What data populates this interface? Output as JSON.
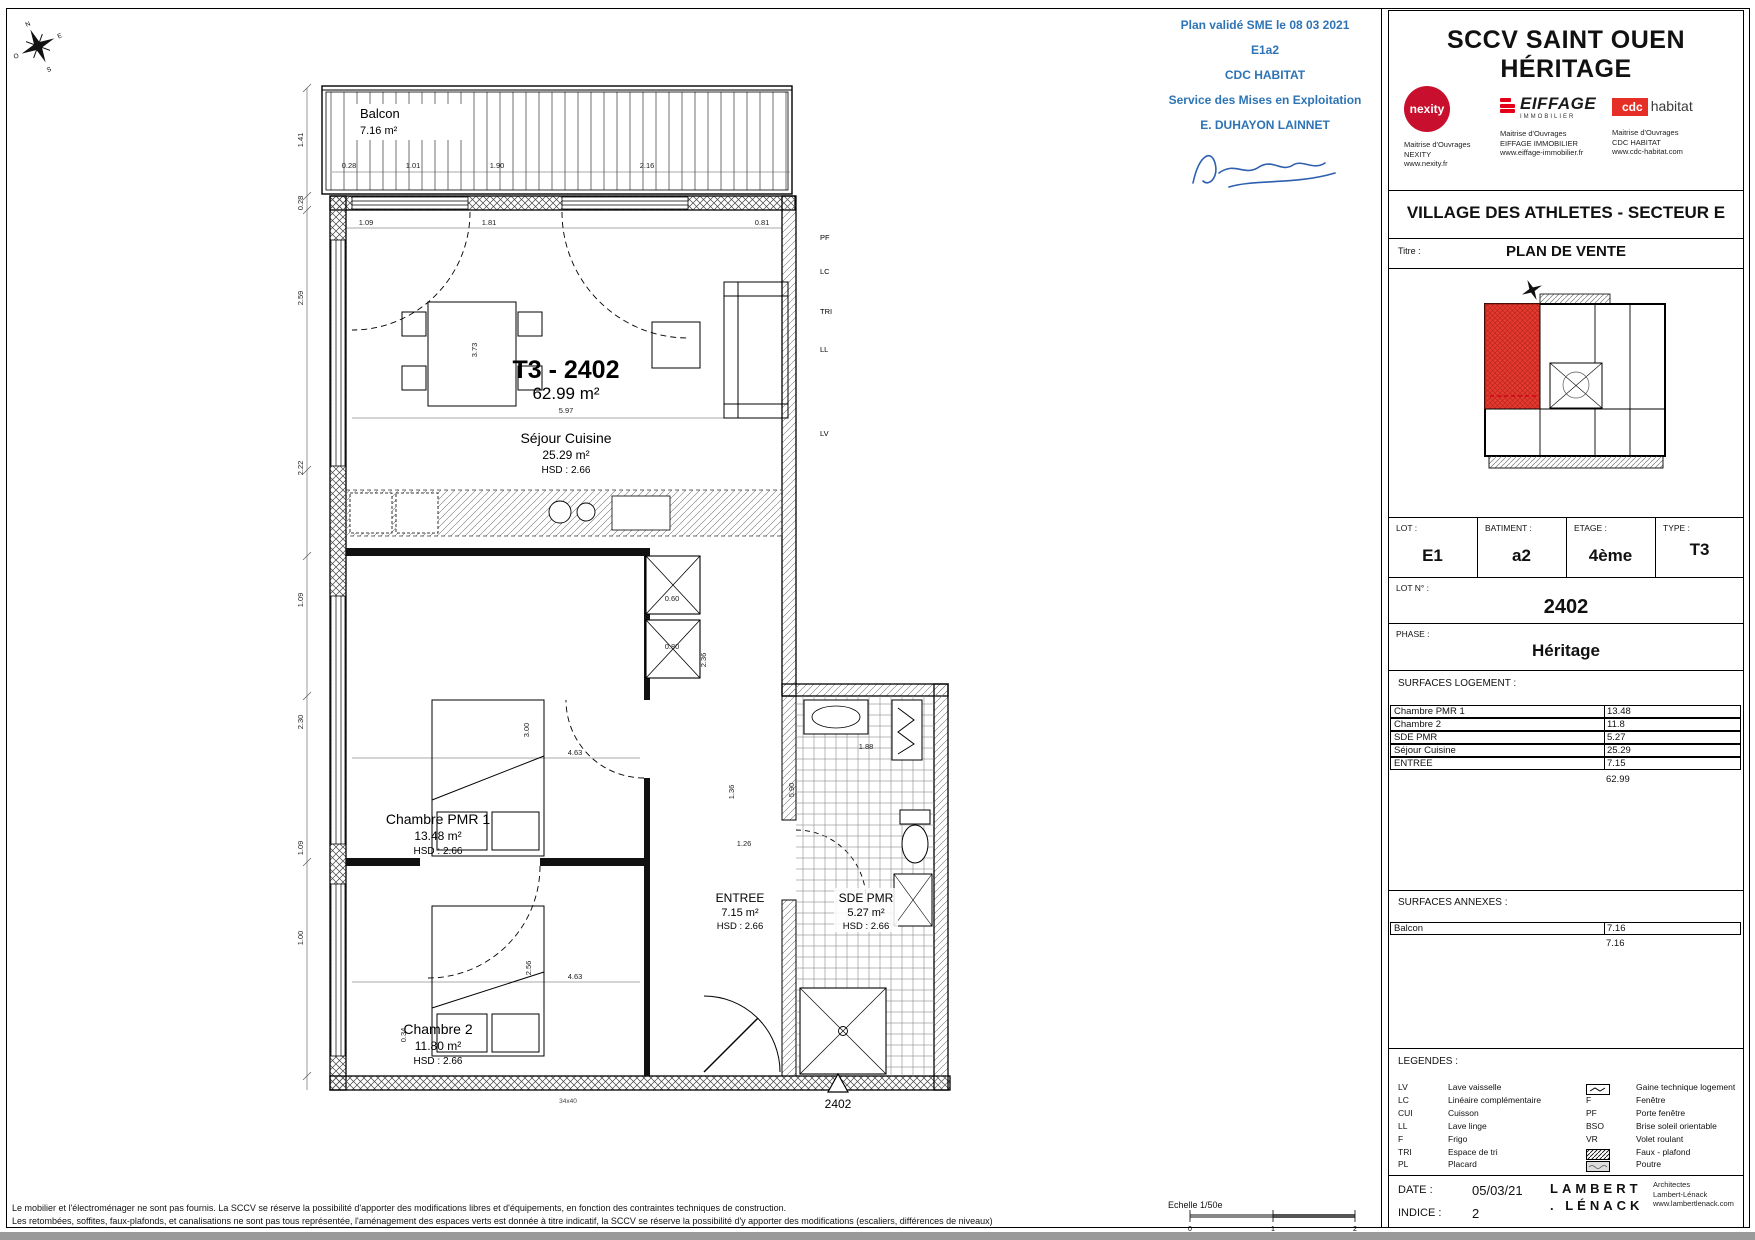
{
  "page": {
    "disclaimer_line1": "Le mobilier et l'électroménager ne sont pas fournis. La SCCV se réserve la possibilité d'apporter des modifications libres et d'équipements, en fonction des contraintes techniques de construction.",
    "disclaimer_line2": "Les retombées, soffites, faux-plafonds, et canalisations ne sont pas tous représentée, l'aménagement des espaces verts est donnée à titre indicatif, la SCCV se réserve la possibilité d'y apporter des modifications (escaliers, différences de niveaux)",
    "scale_label": "Echelle 1/50e",
    "scale_ticks": [
      "0",
      "1",
      "2"
    ]
  },
  "stamp": {
    "line1": "Plan validé SME le 08 03 2021",
    "line2": "E1a2",
    "line3": "CDC HABITAT",
    "line4": "Service des Mises en Exploitation",
    "line5": "E. DUHAYON LAINNET"
  },
  "compass": {
    "n": "N",
    "e": "E",
    "s": "S",
    "o": "O"
  },
  "plan": {
    "unit_code": "T3 - 2402",
    "unit_area": "62.99 m²",
    "rooms": {
      "balcon": {
        "name": "Balcon",
        "area": "7.16 m²"
      },
      "sejour": {
        "name": "Séjour Cuisine",
        "area": "25.29 m²",
        "hsd": "HSD : 2.66"
      },
      "chambre_pmr": {
        "name": "Chambre PMR 1",
        "area": "13.48 m²",
        "hsd": "HSD : 2.66"
      },
      "chambre2": {
        "name": "Chambre 2",
        "area": "11.80 m²",
        "hsd": "HSD : 2.66"
      },
      "entree": {
        "name": "ENTREE",
        "area": "7.15 m²",
        "hsd": "HSD : 2.66"
      },
      "sde": {
        "name": "SDE PMR",
        "area": "5.27 m²",
        "hsd": "HSD : 2.66"
      }
    },
    "marker_lot": "2402",
    "column_note": "34x40",
    "side_labels": [
      "PF",
      "LC",
      "TRI",
      "LL",
      "LV"
    ],
    "dims": [
      "1.41",
      "0.28",
      "2.59",
      "2.22",
      "1.09",
      "2.30",
      "1.09",
      "1.00",
      "0.28",
      "1.01",
      "1.90",
      "2.16",
      "1.09",
      "1.81",
      "0.81",
      "3.73",
      "5.97",
      "3.00",
      "4.63",
      "2.56",
      "0.34",
      "4.63",
      "5.90",
      "1.36",
      "1.26",
      "1.88",
      "2.36",
      "0.60",
      "0.80"
    ]
  },
  "panel": {
    "company": "SCCV SAINT OUEN HÉRITAGE",
    "partners": [
      {
        "name": "nexity",
        "role": "Maitrise d'Ouvrages",
        "org": "NEXITY",
        "url": "www.nexity.fr"
      },
      {
        "name": "EIFFAGE",
        "sub": "IMMOBILIER",
        "role": "Maitrise d'Ouvrages",
        "org": "EIFFAGE IMMOBILIER",
        "url": "www.eiffage-immobilier.fr"
      },
      {
        "name_red": "cdc",
        "name_black": "habitat",
        "role": "Maitrise d'Ouvrages",
        "org": "CDC HABITAT",
        "url": "www.cdc-habitat.com"
      }
    ],
    "project": "VILLAGE DES ATHLETES - SECTEUR E",
    "titre_label": "Titre :",
    "titre_value": "PLAN DE VENTE",
    "lot": {
      "label": "LOT :",
      "value": "E1"
    },
    "batiment": {
      "label": "BATIMENT :",
      "value": "a2"
    },
    "etage": {
      "label": "ETAGE :",
      "value": "4ème"
    },
    "type": {
      "label": "TYPE :",
      "value": "T3"
    },
    "lot_n": {
      "label": "LOT N° :",
      "value": "2402"
    },
    "phase": {
      "label": "PHASE :",
      "value": "Héritage"
    },
    "surfaces_logement": {
      "title": "SURFACES LOGEMENT :",
      "rows": [
        {
          "label": "Chambre PMR 1",
          "value": "13.48"
        },
        {
          "label": "Chambre 2",
          "value": "11.8"
        },
        {
          "label": "SDE PMR",
          "value": "5.27"
        },
        {
          "label": "Séjour Cuisine",
          "value": "25.29"
        },
        {
          "label": "ENTREE",
          "value": "7.15"
        }
      ],
      "total": "62.99"
    },
    "surfaces_annexes": {
      "title": "SURFACES ANNEXES :",
      "rows": [
        {
          "label": "Balcon",
          "value": "7.16"
        }
      ],
      "total": "7.16"
    },
    "legendes": {
      "title": "LEGENDES :",
      "left": [
        {
          "code": "LV",
          "label": "Lave vaisselle"
        },
        {
          "code": "LC",
          "label": "Linéaire complémentaire"
        },
        {
          "code": "CUI",
          "label": "Cuisson"
        },
        {
          "code": "LL",
          "label": "Lave linge"
        },
        {
          "code": "F",
          "label": "Frigo"
        },
        {
          "code": "TRI",
          "label": "Espace de tri"
        },
        {
          "code": "PL",
          "label": "Placard"
        }
      ],
      "right": [
        {
          "icon": "gaine-icon",
          "label": "Gaine technique logement"
        },
        {
          "code": "F",
          "label": "Fenêtre"
        },
        {
          "code": "PF",
          "label": "Porte fenêtre"
        },
        {
          "code": "BSO",
          "label": "Brise soleil orientable"
        },
        {
          "code": "VR",
          "label": "Volet roulant"
        },
        {
          "icon": "faux-plafond-icon",
          "label": "Faux - plafond"
        },
        {
          "icon": "poutre-icon",
          "label": "Poutre"
        }
      ]
    },
    "date": {
      "label": "DATE :",
      "value": "05/03/21"
    },
    "indice": {
      "label": "INDICE :",
      "value": "2"
    },
    "architect": {
      "logo_line1": "LAMBERT",
      "logo_line2": ". LÉNACK",
      "line1": "Architectes",
      "line2": "Lambert-Lénack",
      "line3": "www.lambertlenack.com"
    }
  }
}
